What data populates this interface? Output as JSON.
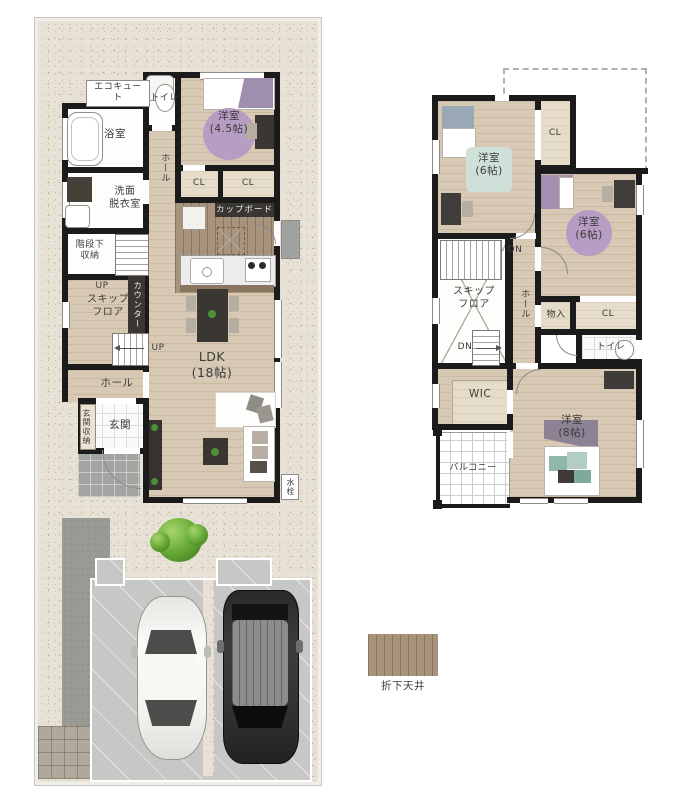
{
  "palette": {
    "wall": "#1b1b1b",
    "wood_floor": "#d8c9b4",
    "lowered_ceiling": "#a8937d",
    "site_gravel": "#e8e2d6",
    "rug_purple": "#b79cc4",
    "rug_blue": "#cfe0d9",
    "porch_gray": "#a3a3a1"
  },
  "floor1": {
    "ecocute": "エコキュート",
    "toilet": "トイレ",
    "bed45": "洋室\n(4.5帖)",
    "bath": "浴室",
    "hall_mid": "ホール",
    "cl_a": "CL",
    "cl_b": "CL",
    "wash": "洗面\n脱衣室",
    "cupboard": "カップボード",
    "understair": "階段下\n収納",
    "up_a": "UP",
    "skip": "スキップ\nフロア",
    "counter": "カウンター",
    "up_b": "UP",
    "ldk": "LDK\n(18帖)",
    "hall_s": "ホール",
    "ent_sto": "玄関収納",
    "entrance": "玄関",
    "faucet": "水栓"
  },
  "floor2": {
    "bed6_nw": "洋室\n(6帖)",
    "cl_n": "CL",
    "bed6_e": "洋室\n(6帖)",
    "dn_a": "DN",
    "hall": "ホール",
    "skip": "スキップ\nフロア",
    "dn_b": "DN",
    "storage": "物入",
    "cl_m": "CL",
    "toilet": "トイレ",
    "wic": "WIC",
    "bed8": "洋室\n(8帖)",
    "balcony": "バルコニー"
  },
  "legend": {
    "lowered_ceiling": "折下天井"
  }
}
